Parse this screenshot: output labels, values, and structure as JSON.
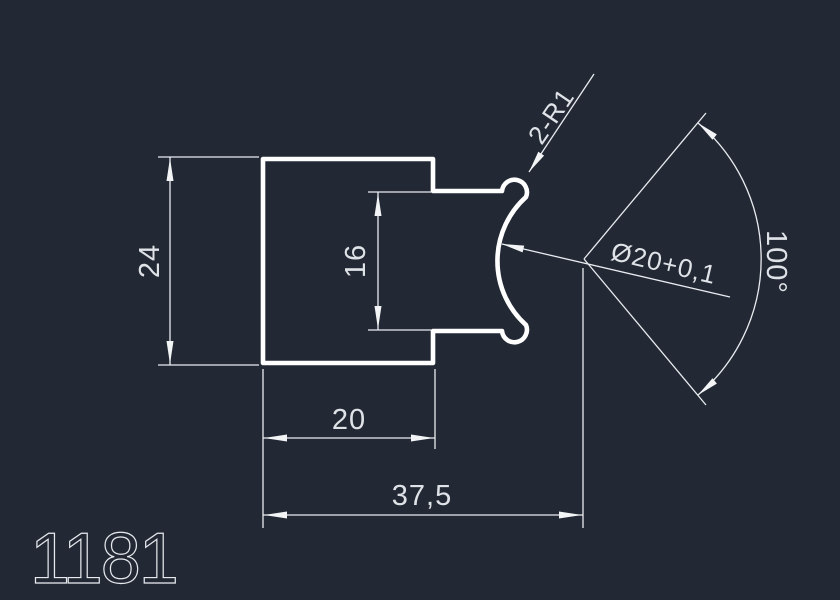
{
  "app": {
    "type": "cad-profile-drawing",
    "background_color": "#232934",
    "profile_line_color": "#ffffff",
    "dimension_color": "#e9ecf0"
  },
  "drawing": {
    "part_number": "1181",
    "labels": {
      "overall_height": "24",
      "opening_height": "16",
      "body_width": "20",
      "overall_width": "37,5",
      "fillet_note": "2-R1",
      "diameter_note": "Ø20+0,1",
      "angle": "100°"
    }
  }
}
